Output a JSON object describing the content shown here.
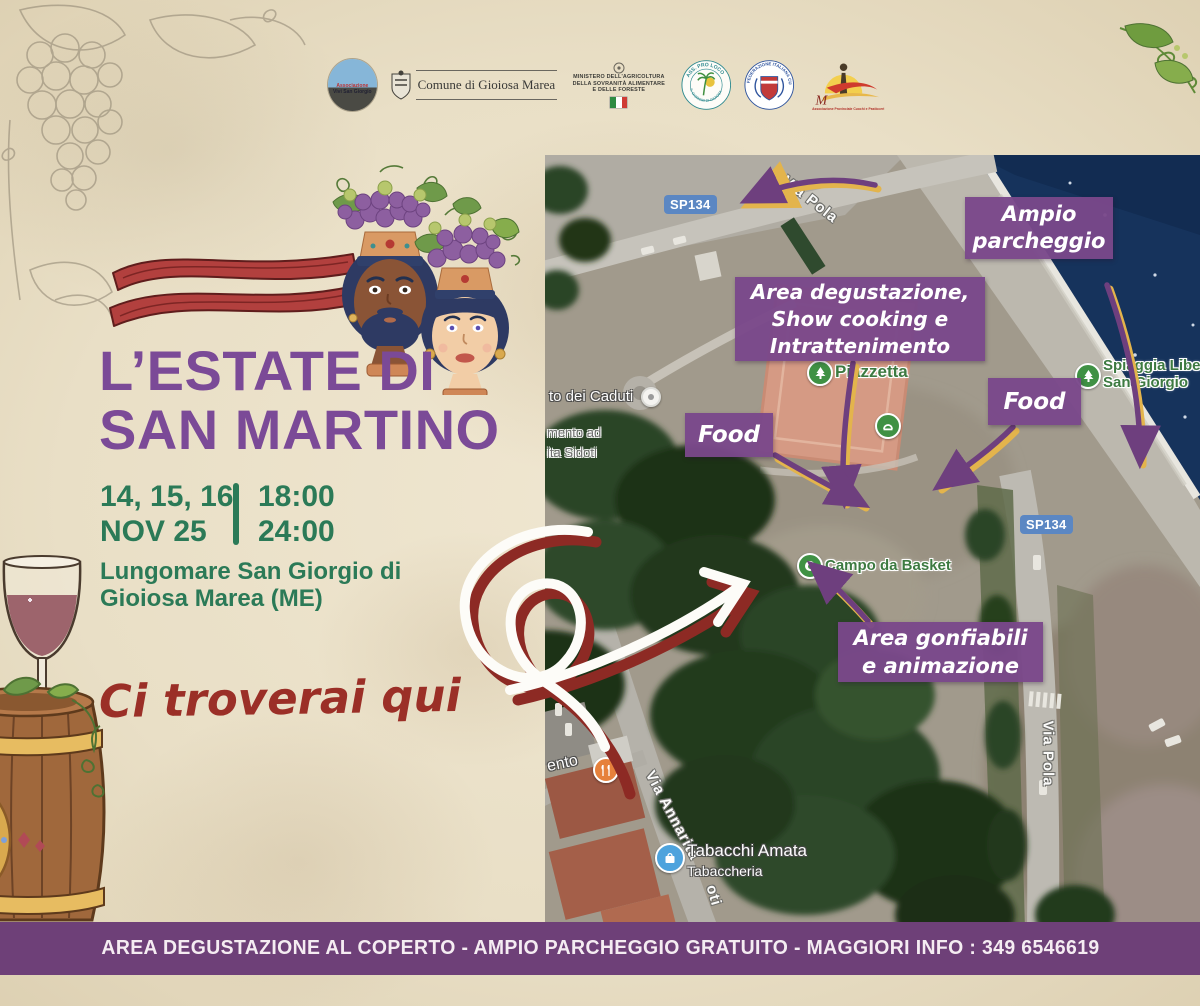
{
  "header_logos": {
    "vivi_san_giorgio": {
      "line1": "Associazione",
      "line2": "Vivi San Giorgio"
    },
    "comune": {
      "label": "Comune di Gioiosa Marea"
    },
    "ministero": {
      "line1": "MINISTERO DELL'AGRICOLTURA",
      "line2": "DELLA SOVRANITÀ ALIMENTARE",
      "line3": "E DELLE FORESTE"
    },
    "pro_loco": {
      "arc_top": "ASS. PRO LOCO",
      "arc_bottom": "S. GIORGIO DI GIOIOSA"
    },
    "fic": {
      "arc": "FEDERAZIONE ITALIANA CUOCHI"
    },
    "cuochi_pasticceri": {
      "script": "M",
      "caption": "Associazione Provinciale Cuochi e Pasticceri"
    }
  },
  "title": {
    "line1": "L’ESTATE DI",
    "line2": "SAN MARTINO"
  },
  "schedule": {
    "dates_top": "14, 15, 16",
    "dates_bottom": "NOV 25",
    "time_top": "18:00",
    "time_bottom": "24:00"
  },
  "address": {
    "line1": "Lungomare San Giorgio di",
    "line2": "Gioiosa Marea (ME)"
  },
  "tagline": "Ci troverai qui",
  "map": {
    "annotations": {
      "parcheggio": {
        "line1": "Ampio",
        "line2": "parcheggio"
      },
      "degustazione": {
        "line1": "Area degustazione,",
        "line2": "Show cooking e",
        "line3": "Intrattenimento"
      },
      "food_left": {
        "line1": "Food"
      },
      "food_right": {
        "line1": "Food"
      },
      "gonfiabili": {
        "line1": "Area gonfiabili",
        "line2": "e animazione"
      }
    },
    "roads": {
      "sp134_top": "SP134",
      "sp134_right": "SP134",
      "via_pola_top": "Via Pola",
      "via_pola_right": "Via Pola",
      "via_annarita": "Via Annarita",
      "via_annarita_tail": "oti"
    },
    "pois": {
      "caduti": "to dei Caduti",
      "sidoti_partial1": "mento ad",
      "sidoti_partial2": "ita Sidoti",
      "piazzetta": "Piazzetta",
      "spiaggia_line1": "Spiaggia Libera",
      "spiaggia_line2": "San Giorgio",
      "basket": "Campo da Basket",
      "tabacchi": "Tabacchi Amata",
      "tabaccheria": "Tabaccheria",
      "ristorante_partial": "ento"
    }
  },
  "footer": {
    "text": "AREA DEGUSTAZIONE AL COPERTO - AMPIO PARCHEGGIO GRATUITO - MAGGIORI INFO : 349 6546619"
  },
  "colors": {
    "title_purple": "#7b4a97",
    "schedule_green": "#2b7a57",
    "tagline_red": "#9b2f27",
    "annotation_purple": "#7a488a",
    "footer_purple": "#6e4078",
    "parchment": "#e9dfc6",
    "sea_blue": "#16335c",
    "arrow_purple": "#6e3f7e",
    "arrow_yellow": "#e3b44c"
  }
}
